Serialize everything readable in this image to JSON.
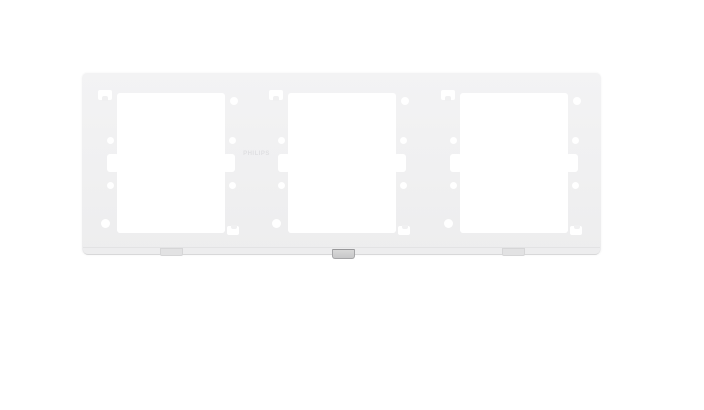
{
  "product": {
    "brand_embossed": "PHILIPS",
    "description": "White Philips 3-gang switch/socket mounting frame photographed on a plain white background",
    "gang_count": 3
  },
  "colors": {
    "background": "#ffffff",
    "faceplate": "#f0f0f1",
    "clip": "#c7c7c8",
    "embossed_text": "#dfdfe2"
  }
}
